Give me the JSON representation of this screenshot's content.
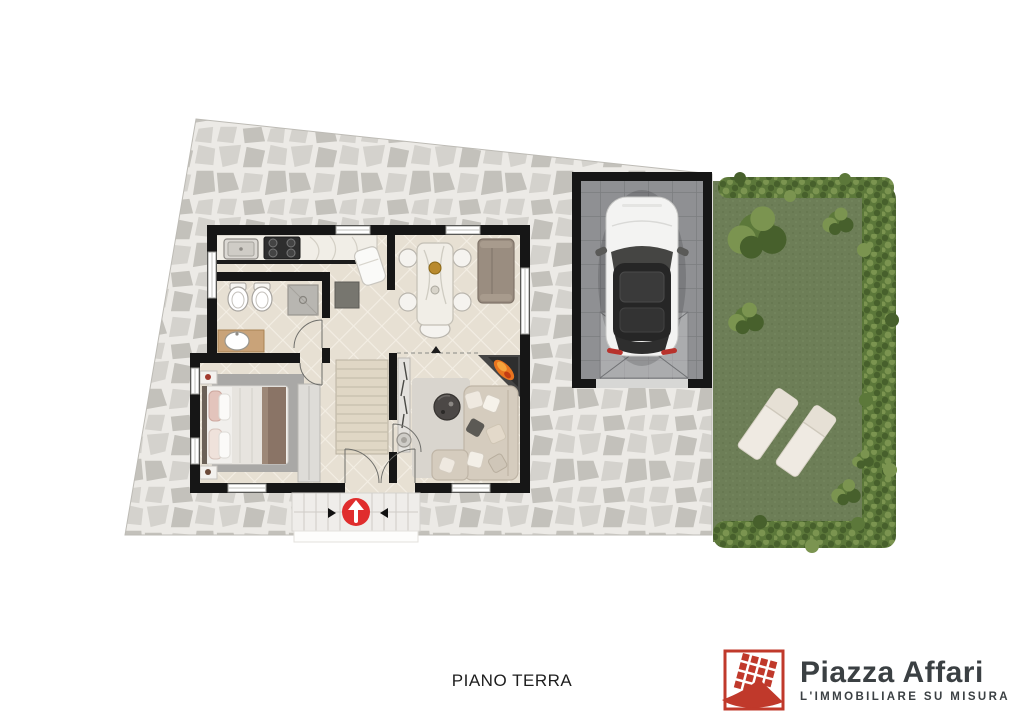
{
  "caption": {
    "text": "PIANO TERRA"
  },
  "branding": {
    "brand_name": "Piazza Affari",
    "tagline": "L'IMMOBILIARE SU MISURA",
    "logo_icon": "red-building-grid-icon"
  },
  "plan": {
    "floor_label": "PIANO TERRA",
    "entrance_marker": "up-arrow-in-red-circle",
    "zones": [
      "paved-courtyard",
      "kitchen",
      "bathroom",
      "dining-room",
      "bedroom",
      "hallway-stairs",
      "living-room",
      "entrance-steps",
      "garage",
      "garden"
    ],
    "objects": {
      "kitchen": [
        "counter",
        "sink",
        "stove"
      ],
      "bathroom": [
        "bidet",
        "toilet",
        "shower",
        "vanity-sink"
      ],
      "dining-room": [
        "dining-table",
        "chairs",
        "sofa",
        "armchair"
      ],
      "bedroom": [
        "double-bed",
        "rug",
        "nightstands",
        "wardrobe"
      ],
      "hallway-stairs": [
        "staircase",
        "storage-unit"
      ],
      "living-room": [
        "corner-sofa",
        "coffee-table",
        "fireplace",
        "console-shelf",
        "rug"
      ],
      "garage": [
        "car",
        "door-apron"
      ],
      "garden": [
        "lawn",
        "hedges",
        "bushes",
        "sun-loungers"
      ]
    }
  },
  "colors": {
    "accent_red": "#e02d2d",
    "brand_red": "#c0392b",
    "brand_text": "#3b4043",
    "wall": "#161616",
    "stone_base": "#d4d2cd",
    "stone_dark": "#c3c1bb",
    "stone_joint": "#eceae6",
    "tile_floor": "#e7e0d3",
    "tile_line": "#f3eee4",
    "lawn": "#6d7e57",
    "hedge_dark": "#47602c",
    "hedge_mid": "#5c783a",
    "hedge_light": "#7b9450",
    "garage_floor": "#8f9093",
    "garage_line": "#7c7d80",
    "marble": "#f1eee7",
    "wood": "#c9a379",
    "sofa_beige": "#d5ccbe",
    "sofa_gray": "#9a8d80",
    "rug_gray": "#a9a8a6",
    "blanket_brown": "#8a7466",
    "flame_orange": "#e8741f",
    "car_body": "#f3f3f2",
    "car_roof": "#262626"
  }
}
